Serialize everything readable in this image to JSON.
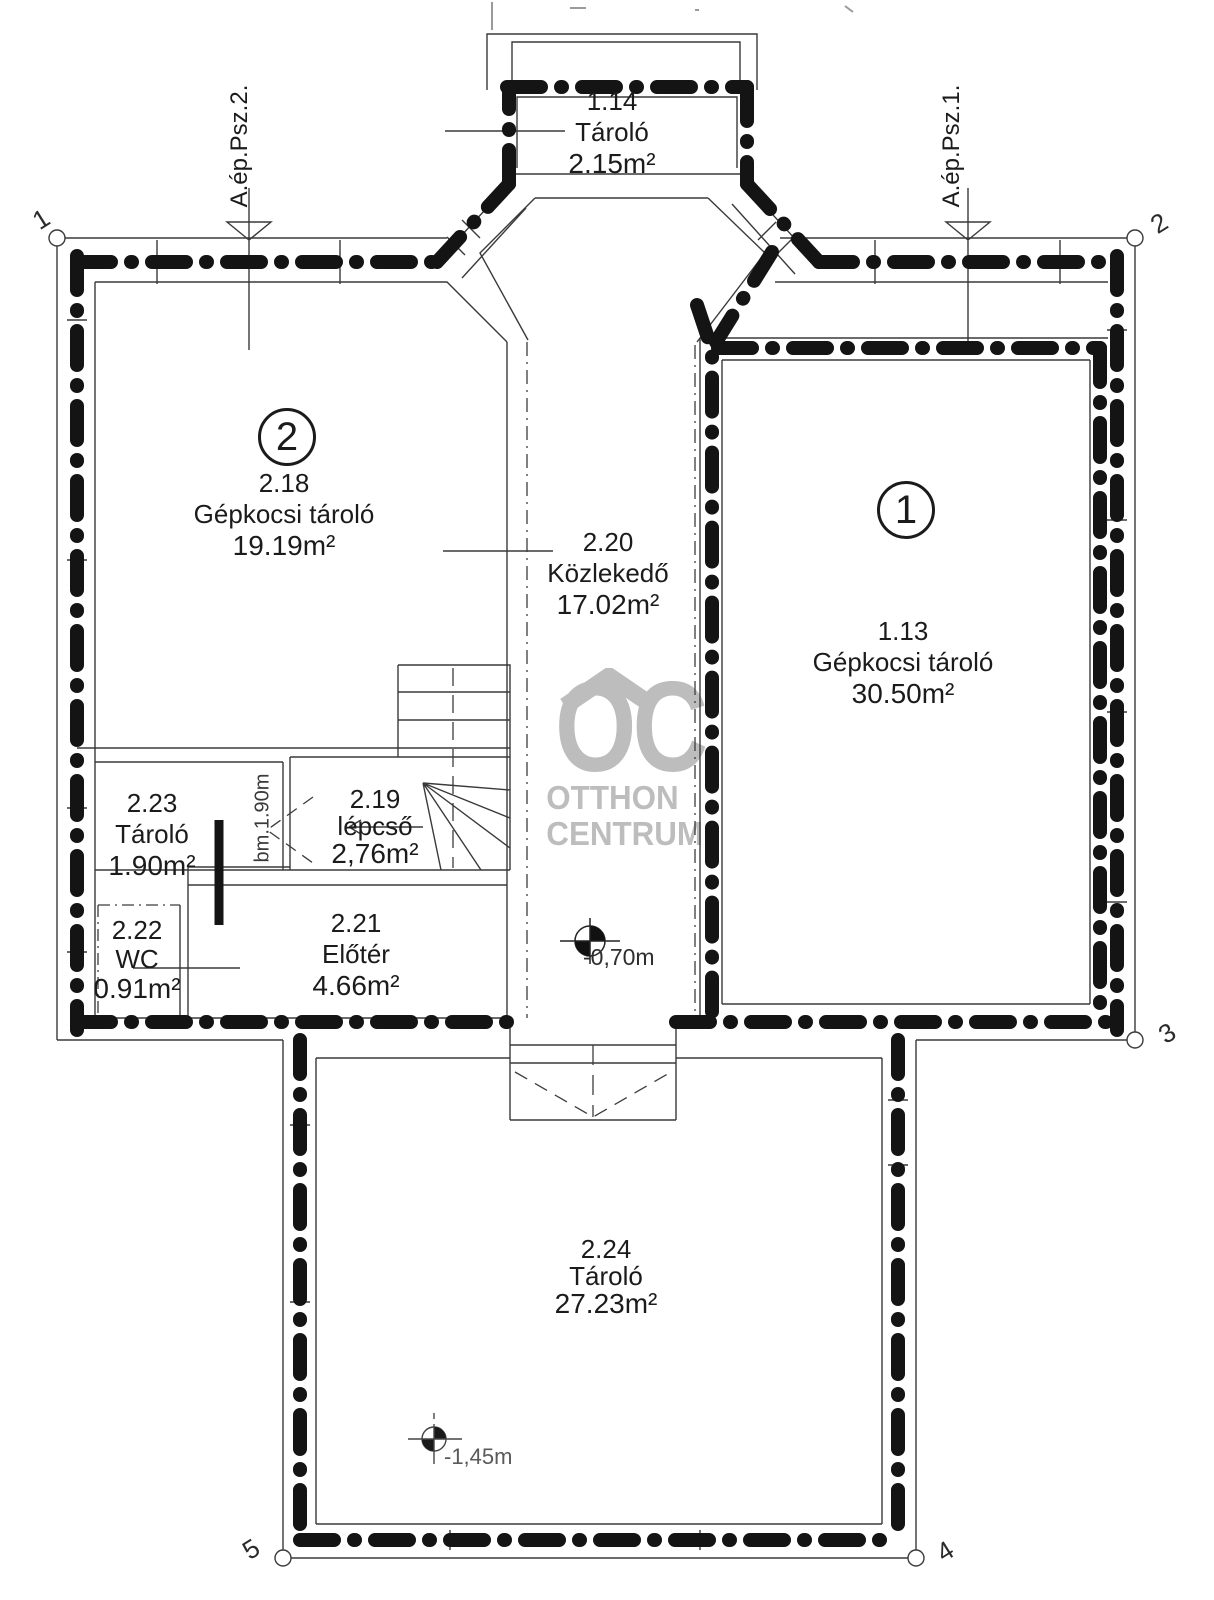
{
  "watermark": {
    "logo": "OC",
    "line1": "OTTHON",
    "line2": "CENTRUM",
    "color": "#bdbdbd"
  },
  "section_markers": {
    "left": "A.ép.Psz.2.",
    "right": "A.ép.Psz.1."
  },
  "unit_badges": {
    "left_unit": "2",
    "right_unit": "1"
  },
  "rooms": {
    "r114": {
      "id": "1.14",
      "name": "Tároló",
      "area": "2.15m²"
    },
    "r218": {
      "id": "2.18",
      "name": "Gépkocsi tároló",
      "area": "19.19m²"
    },
    "r220": {
      "id": "2.20",
      "name": "Közlekedő",
      "area": "17.02m²"
    },
    "r113": {
      "id": "1.13",
      "name": "Gépkocsi tároló",
      "area": "30.50m²"
    },
    "r223": {
      "id": "2.23",
      "name": "Tároló",
      "area": "1.90m²"
    },
    "r219": {
      "id": "2.19",
      "name": "lépcső",
      "area": "2,76m²"
    },
    "r222": {
      "id": "2.22",
      "name": "WC",
      "area": "0.91m²"
    },
    "r221": {
      "id": "2.21",
      "name": "Előtér",
      "area": "4.66m²"
    },
    "r224": {
      "id": "2.24",
      "name": "Tároló",
      "area": "27.23m²"
    }
  },
  "annotations": {
    "stair_headroom": "bm.1.90m",
    "elevation_upper": "-0,70m",
    "elevation_lower": "-1,45m"
  },
  "corner_markers": {
    "m1": "1",
    "m2": "2",
    "m3": "3",
    "m4": "4",
    "m5": "5"
  }
}
